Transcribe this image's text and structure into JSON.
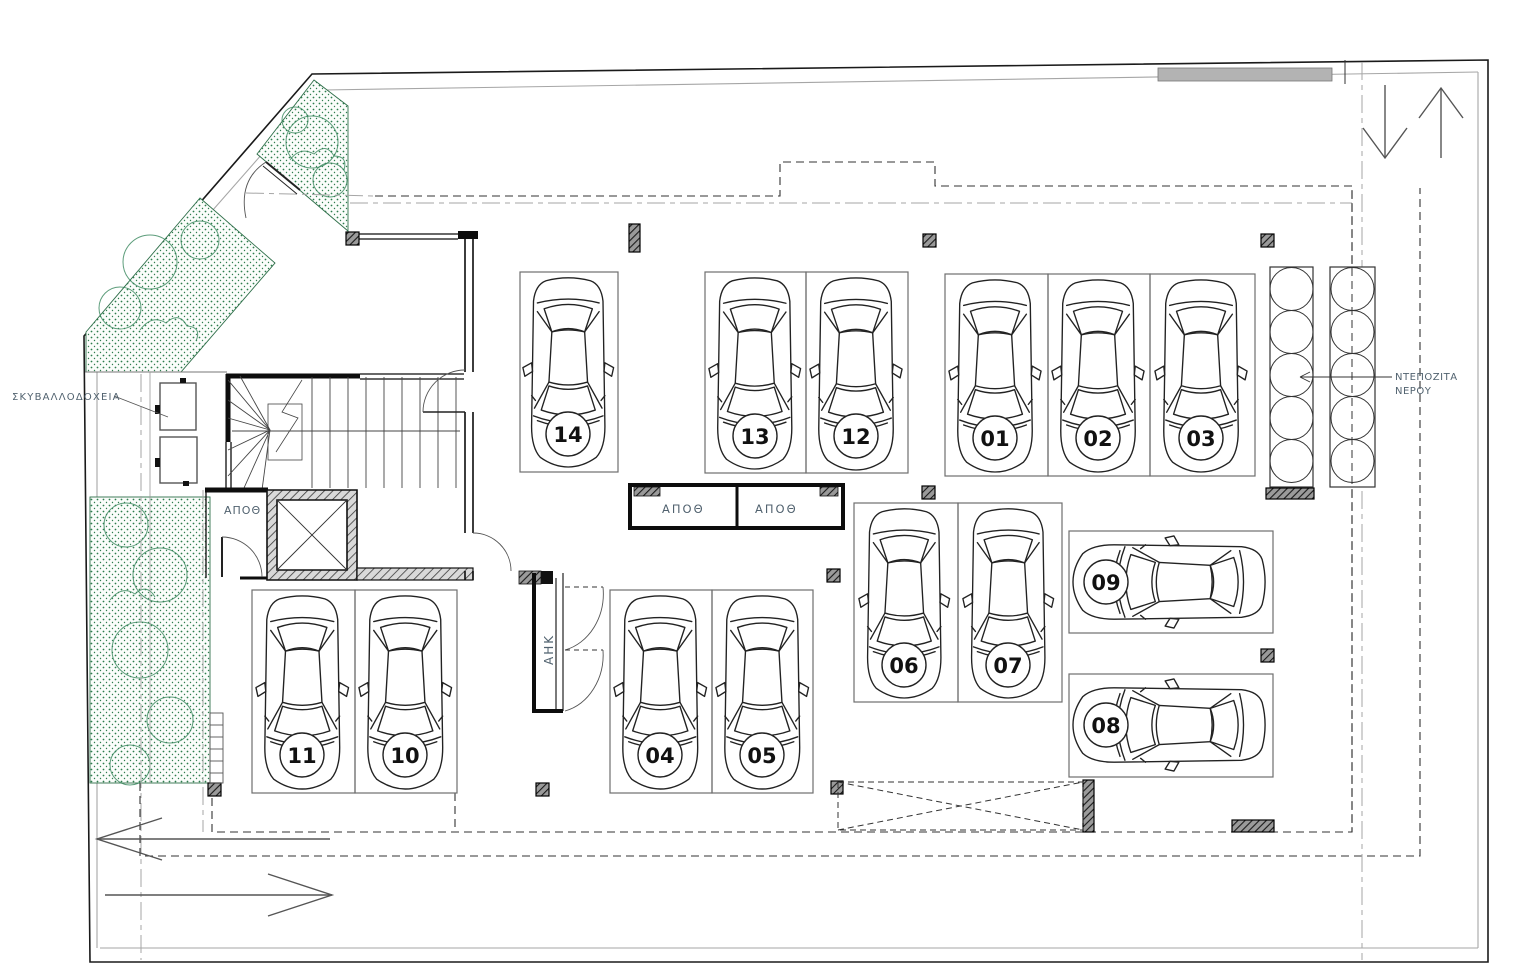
{
  "document": {
    "type": "architectural floor plan",
    "content": "basement parking level with 14 numbered parking spots, staircase, elevator, storage rooms, planted areas and water tanks"
  },
  "labels": {
    "trash_bins": "ΣΚΥΒΑΛΛΟΔΟΧΕΙΑ",
    "storage_room_left": "ΑΠΟΘ",
    "storage_room_center_left": "ΑΠΟΘ",
    "storage_room_center_right": "ΑΠΟΘ",
    "electrical_room": "ΑΗΚ",
    "water_tanks_line1": "ΝΤΕΠΟΖΙΤΑ",
    "water_tanks_line2": "ΝΕΡΟΥ"
  },
  "parking_spots": [
    {
      "number": "14"
    },
    {
      "number": "13"
    },
    {
      "number": "12"
    },
    {
      "number": "01"
    },
    {
      "number": "02"
    },
    {
      "number": "03"
    },
    {
      "number": "06"
    },
    {
      "number": "07"
    },
    {
      "number": "04"
    },
    {
      "number": "05"
    },
    {
      "number": "11"
    },
    {
      "number": "10"
    },
    {
      "number": "09"
    },
    {
      "number": "08"
    }
  ],
  "colors": {
    "vegetation_green": "#2e7d4e",
    "line_black": "#1a1a1a",
    "label_blue_gray": "#51626f",
    "boundary_gray": "#a6a6a6"
  }
}
